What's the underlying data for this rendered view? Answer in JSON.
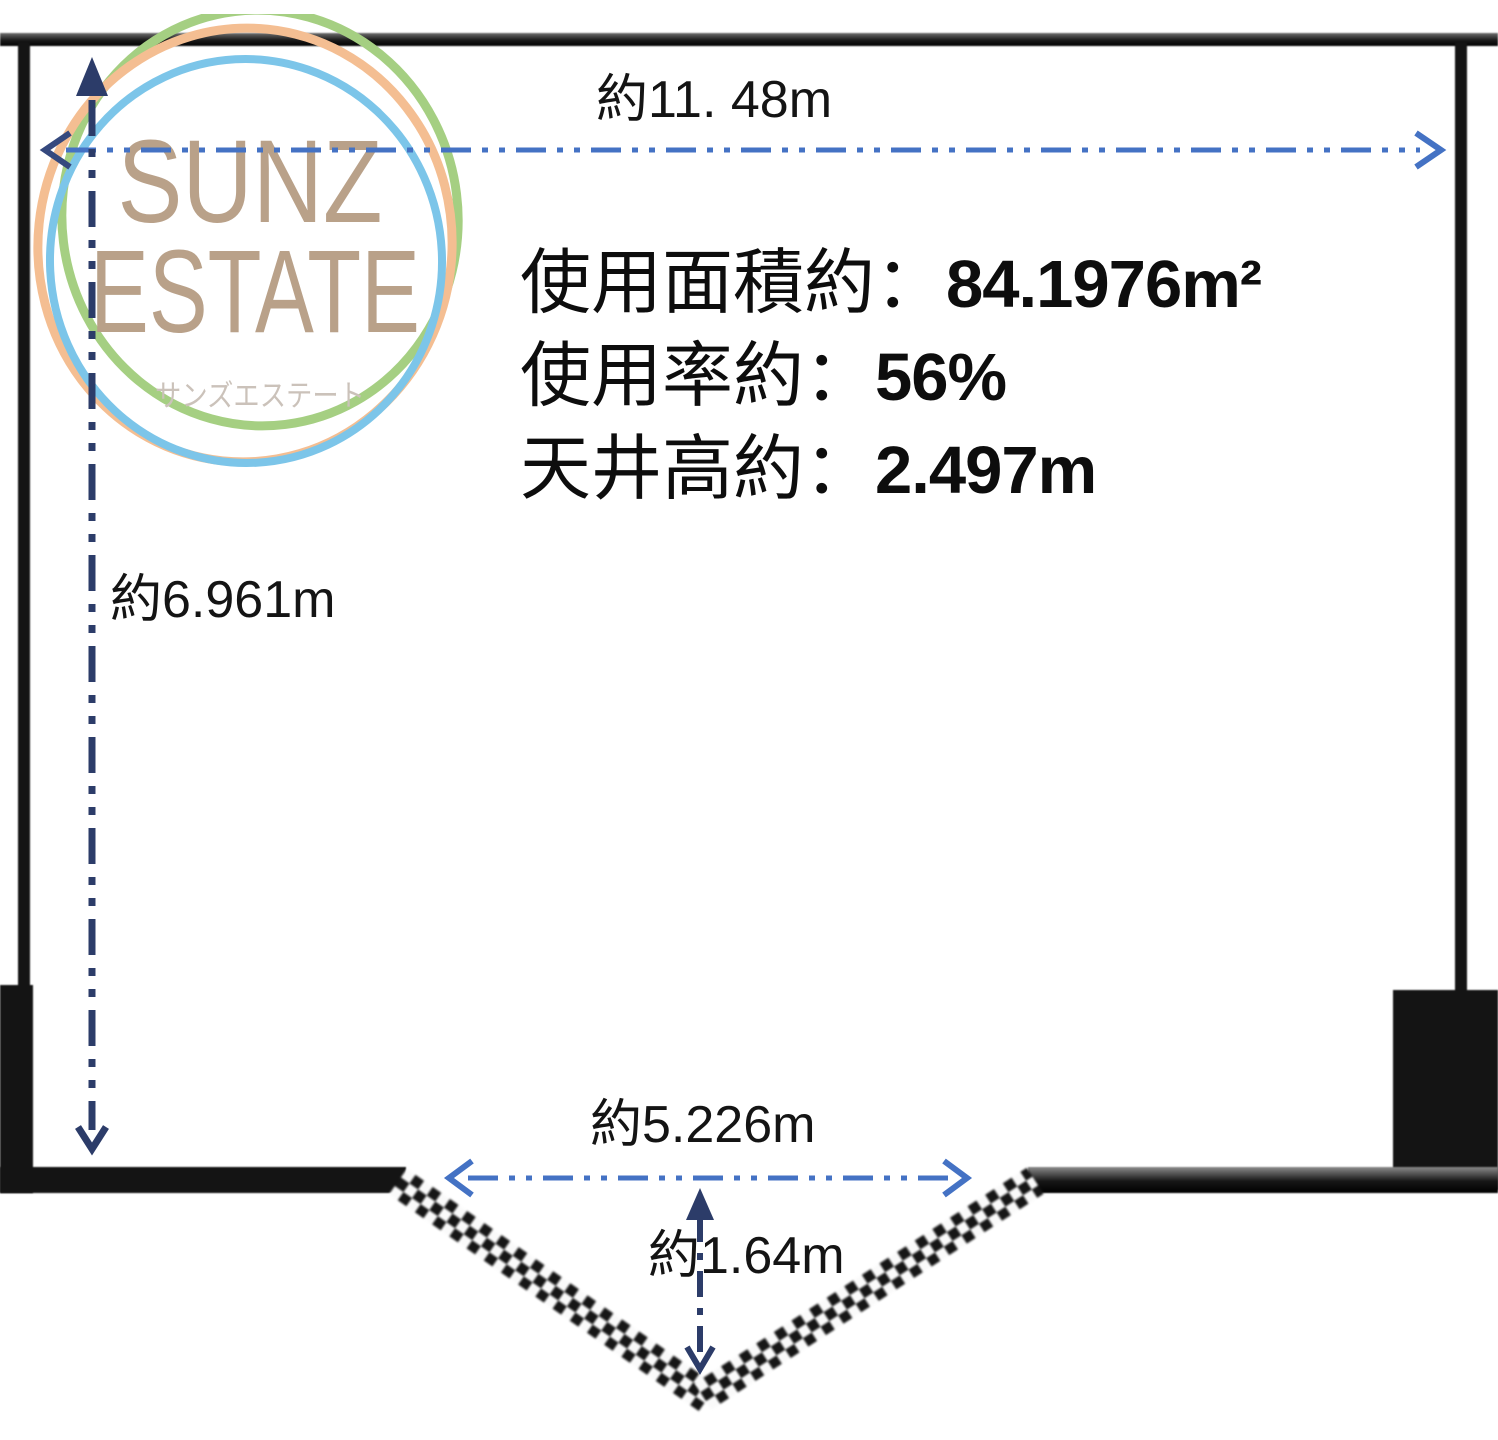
{
  "page": {
    "background": "#ffffff",
    "type": "floor-plan-diagram"
  },
  "logo": {
    "name_line1": "SUNZ",
    "name_line2": "ESTATE",
    "subtitle": "サンズエステート",
    "colors": {
      "circle_green": "#A5CF82",
      "circle_orange": "#F4BE92",
      "circle_blue": "#7CC5E9",
      "wordmark_text": "#B9A189",
      "subtitle_text": "#CBC2BA"
    }
  },
  "info": {
    "lines": [
      {
        "label": "使用面積約：",
        "value": "84.1976m²"
      },
      {
        "label": "使用率約：",
        "value": "56%"
      },
      {
        "label": "天井高約：",
        "value": "2.497m"
      }
    ]
  },
  "dimensions": {
    "width_top": {
      "label": "約11. 48m"
    },
    "height_left": {
      "label": "約6.961m"
    },
    "opening_bottom": {
      "label": "約5.226m"
    },
    "notch_depth": {
      "label": "約1.64m"
    }
  },
  "colors": {
    "wall": "#141414",
    "dimension_blue": "#4472C4",
    "dimension_navy": "#2C3C69",
    "label_text": "#141414"
  }
}
